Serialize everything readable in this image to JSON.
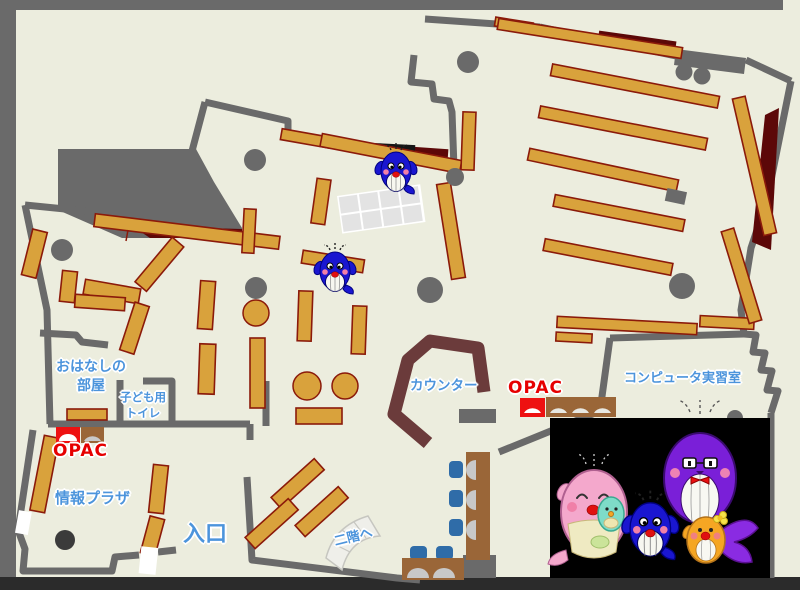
{
  "canvas": {
    "width": 800,
    "height": 590
  },
  "labels": {
    "storytelling_room": {
      "line1": "おはなしの",
      "line2": "部屋"
    },
    "kids_toilet": {
      "line1": "子ども用",
      "line2": "トイレ"
    },
    "opac_left": "OPAC",
    "opac_right": "OPAC",
    "info_plaza": "情報プラザ",
    "entrance": "入口",
    "counter": "カウンター",
    "computer_room": "コンピュータ実習室",
    "stairs_up": "二階へ"
  },
  "colors": {
    "floor": "#ECEDDE",
    "wall_gray": "#6A6A6A",
    "bottom_bar": "#2B2B2B",
    "shelf_fill": "#D9A23C",
    "shelf_border": "#8B1A0A",
    "dead_space_maroon": "#5C0808",
    "counter_brown": "#6B3B3B",
    "desk_brown": "#9A6638",
    "chair_blue": "#2F6CA8",
    "opac_red": "#EE1111",
    "label_blue": "#4C94DC",
    "mascot_panel": "#000000",
    "whale_blue": "#1A16D0",
    "whale_pink": "#F4A8CC",
    "whale_purple": "#7A1FD8",
    "whale_orange": "#F5A623",
    "whale_teal": "#7EDCC8"
  },
  "mascots": {
    "on_map_whale_icons": 2,
    "family_panel_icons": [
      "pink-mother-whale-icon",
      "teal-baby-whale-icon",
      "purple-father-whale-icon",
      "blue-child-whale-icon",
      "orange-small-whale-icon"
    ]
  }
}
